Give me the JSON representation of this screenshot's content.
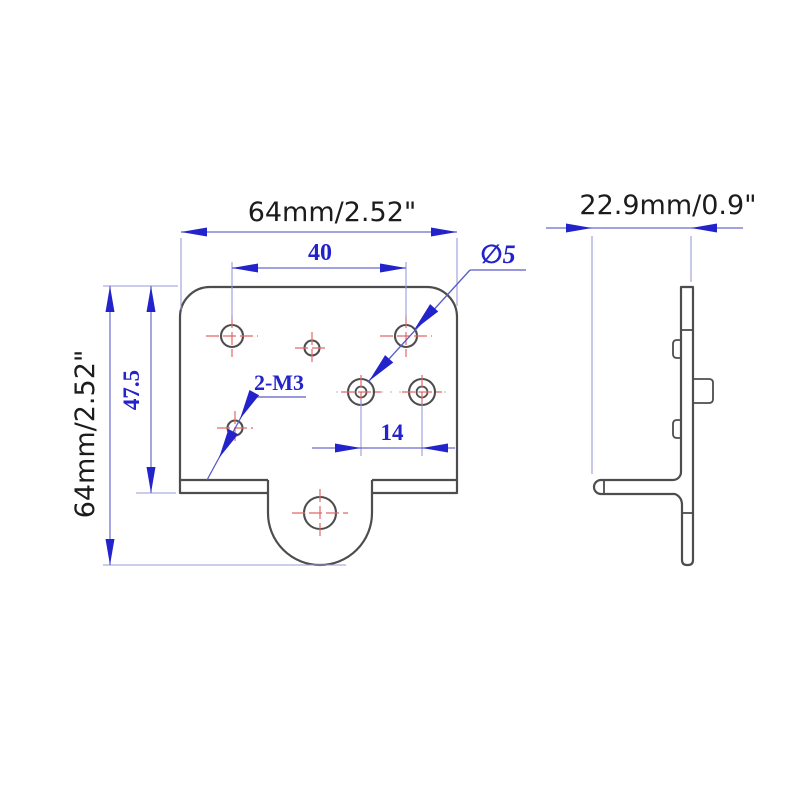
{
  "title": "Corner bracket technical drawing",
  "colors": {
    "background": "#ffffff",
    "outline_gray": "#4d4d4d",
    "dimension_blue": "#2323cb",
    "extension_blue": "#9a9ad8",
    "centermark_red": "#e06868",
    "text_black": "#1c1c1c"
  },
  "front_view": {
    "dim_total_width": "64mm/2.52\"",
    "dim_hole_span_top": "40",
    "dim_total_height": "64mm/2.52\"",
    "dim_body_height": "47.5",
    "dim_hole_span_bottom": "14",
    "callout_hole_diameter": "∅5",
    "callout_thread": "2-M3"
  },
  "side_view": {
    "dim_depth": "22.9mm/0.9\""
  }
}
